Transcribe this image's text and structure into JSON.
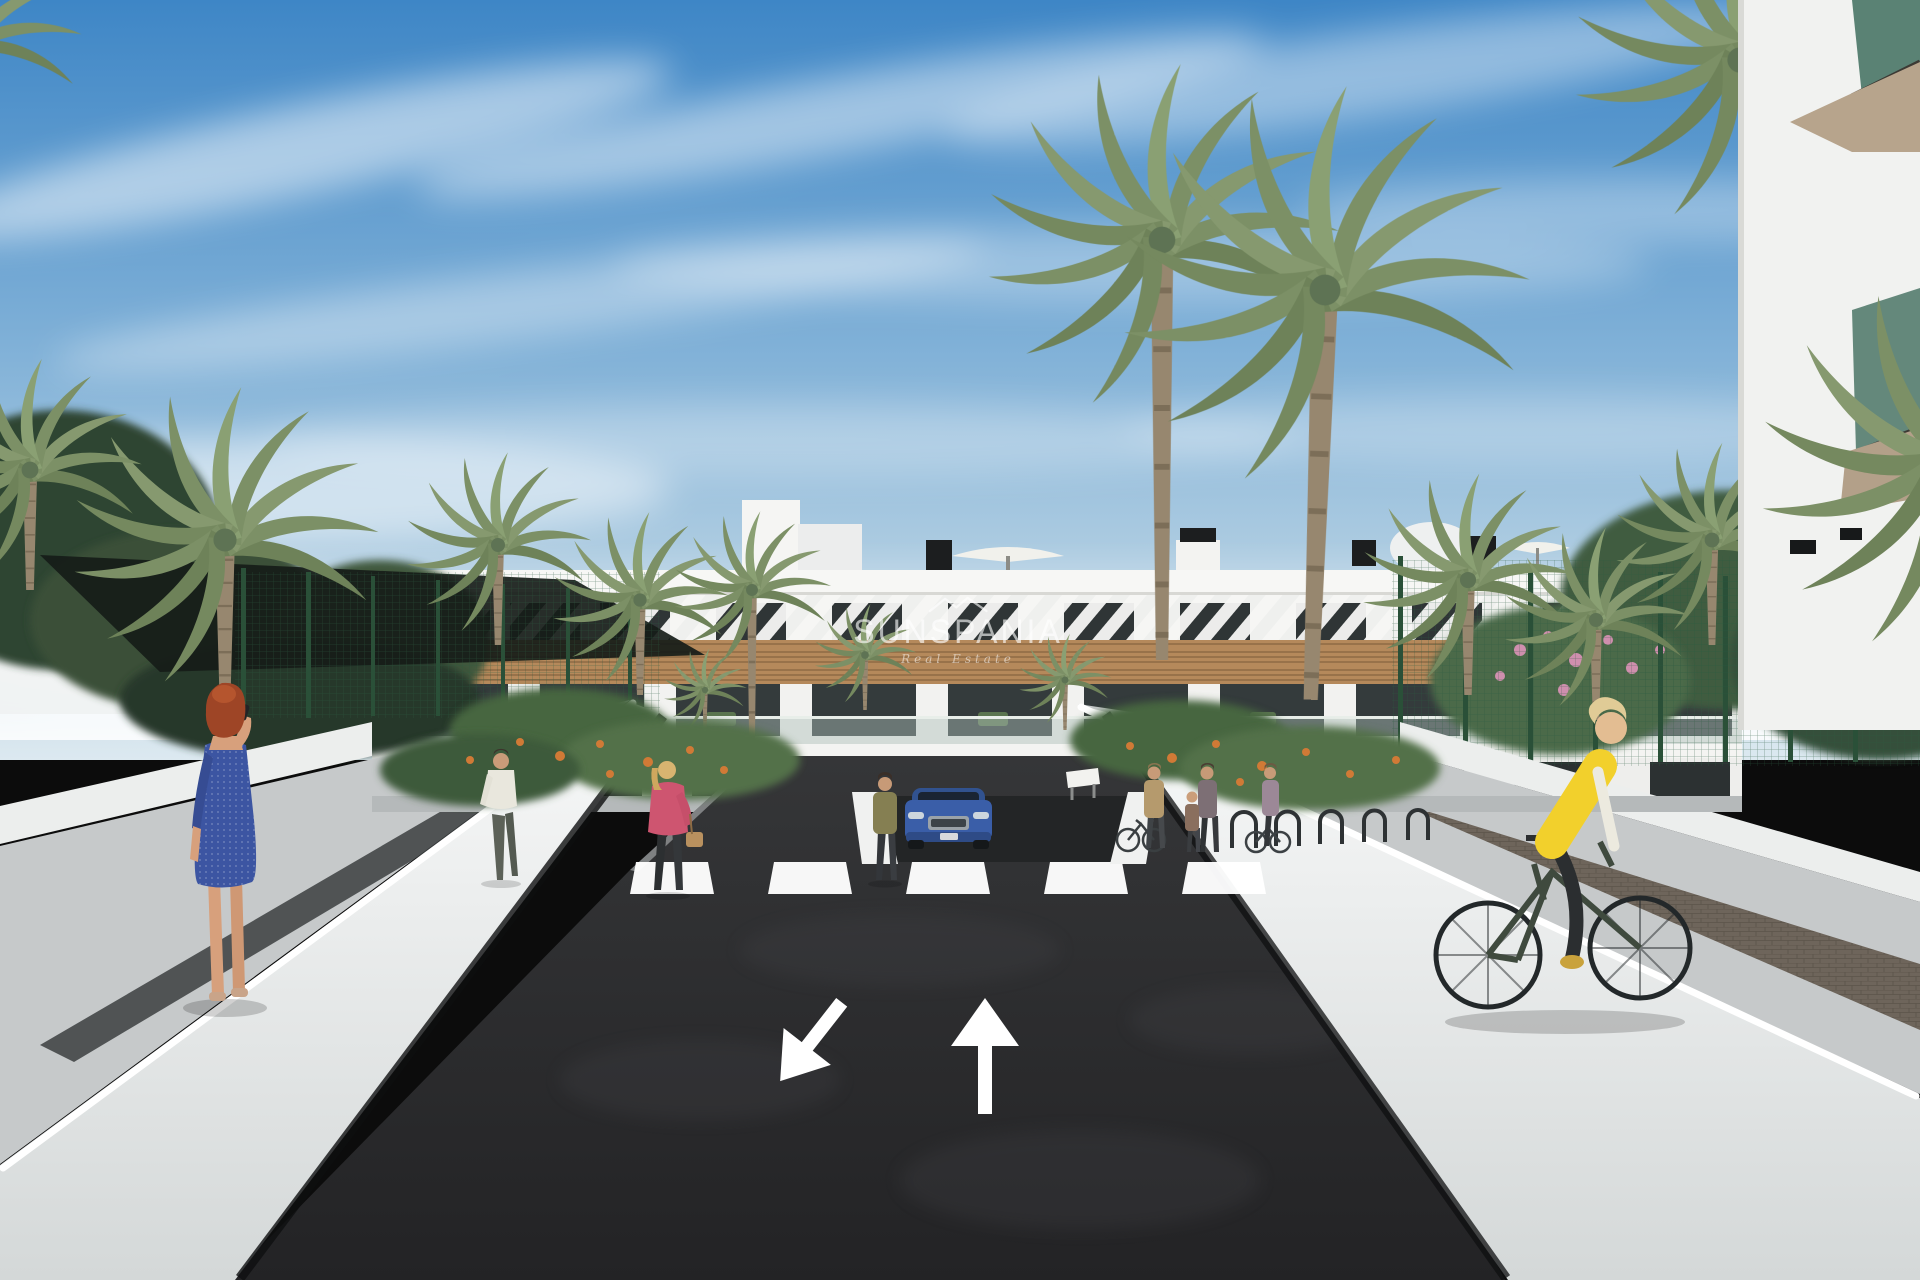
{
  "scene": {
    "setting": "3D architectural render: modern white three-storey apartment complex with palm trees, two-way access road, crosswalk, underground garage entrance, pedestrians and a cyclist",
    "sky": {
      "top_color": "#3e86c6",
      "mid_color": "#8fb8da",
      "horizon_color": "#dce9f0",
      "clouds": "diagonal wispy white streaks"
    },
    "building": {
      "wall_color": "#f2f2f0",
      "wood_cladding_color": "#b5895b",
      "glazing_color": "#2f3536",
      "louver_color": "#f6f6f4",
      "storeys": 3,
      "rooftop_items": [
        "white parasols",
        "black vents",
        "white volumes"
      ]
    },
    "road": {
      "asphalt_color": "#2b2b2d",
      "marking_color": "#ffffff",
      "crosswalk_stripe_count": 5,
      "lane_arrows": [
        "arrow-toward-viewer-down-left",
        "arrow-away-from-viewer-up"
      ],
      "garage_ramp": "underground garage entrance at building center"
    },
    "hardscape": {
      "retaining_wall_color": "#eceeee",
      "sidewalk_color": "#c6c9ca",
      "paver_strip_color": "#6e655b",
      "tactile_strip_color": "#3b3e40"
    },
    "vegetation": {
      "palm_count_approx": 13,
      "fence_color": "#2c5a40",
      "flower_color_left": "#d07a36",
      "flower_color_right": "#cf8fae",
      "shade_sail_color": "#161c18"
    },
    "vehicles": [
      {
        "type": "suv",
        "color": "#3a5ea8",
        "position": "exiting underground garage at building entrance"
      }
    ],
    "people": [
      {
        "id": "woman-blue-dress",
        "hair": "#9e4526",
        "outfit": "#3c55a2",
        "activity": "walking with phone to ear",
        "location": "left sidewalk foreground"
      },
      {
        "id": "man-white-shirt",
        "outfit": "#e9e7dd",
        "location": "left garden path"
      },
      {
        "id": "woman-pink-jacket",
        "outfit": "#ce5570",
        "accessory": "tan handbag",
        "location": "left garden path"
      },
      {
        "id": "woman-olive-top",
        "outfit": "#857f52",
        "location": "near garage entrance"
      },
      {
        "id": "pedestrians-at-bike-racks",
        "count": 4,
        "location": "right path near bike racks"
      },
      {
        "id": "cyclist-yellow-vest",
        "outfit": "#f2d02c",
        "bike_color": "#3f4a3e",
        "location": "right sidewalk foreground"
      }
    ]
  },
  "watermark": {
    "brand": "SUNSPANIA",
    "tagline": "Real Estate",
    "logo_icon": "house-roofline-icon",
    "color": "#ffffff"
  }
}
